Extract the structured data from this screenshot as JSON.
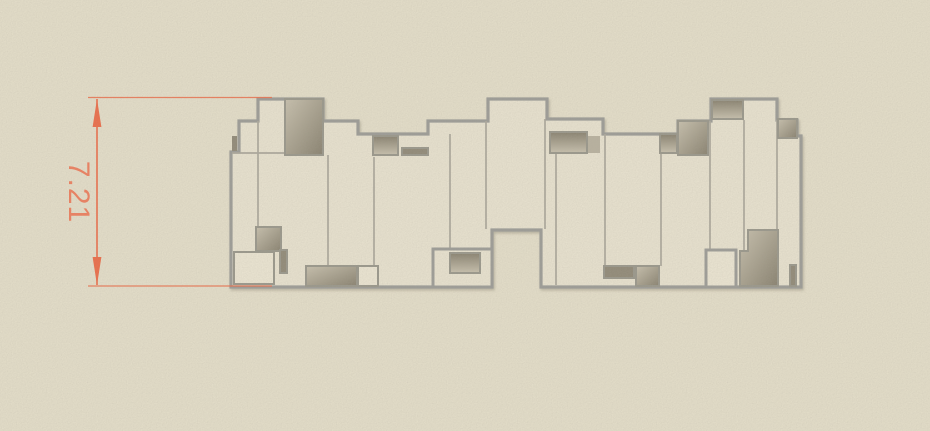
{
  "viewport": {
    "width": 930,
    "height": 431,
    "background_color": "#e5dfca"
  },
  "dimension": {
    "value": "7.21",
    "text_color": "#ef7d5c",
    "line_color": "#ed6a46"
  },
  "drawing": {
    "outline_color": "#9b9b96",
    "inner_line_color": "#ab a79b",
    "fill_color": "#e9e3d0",
    "recess_dark": "#867f6d",
    "recess_light": "#c8c1ae",
    "shadow_color": "#6b6557"
  }
}
